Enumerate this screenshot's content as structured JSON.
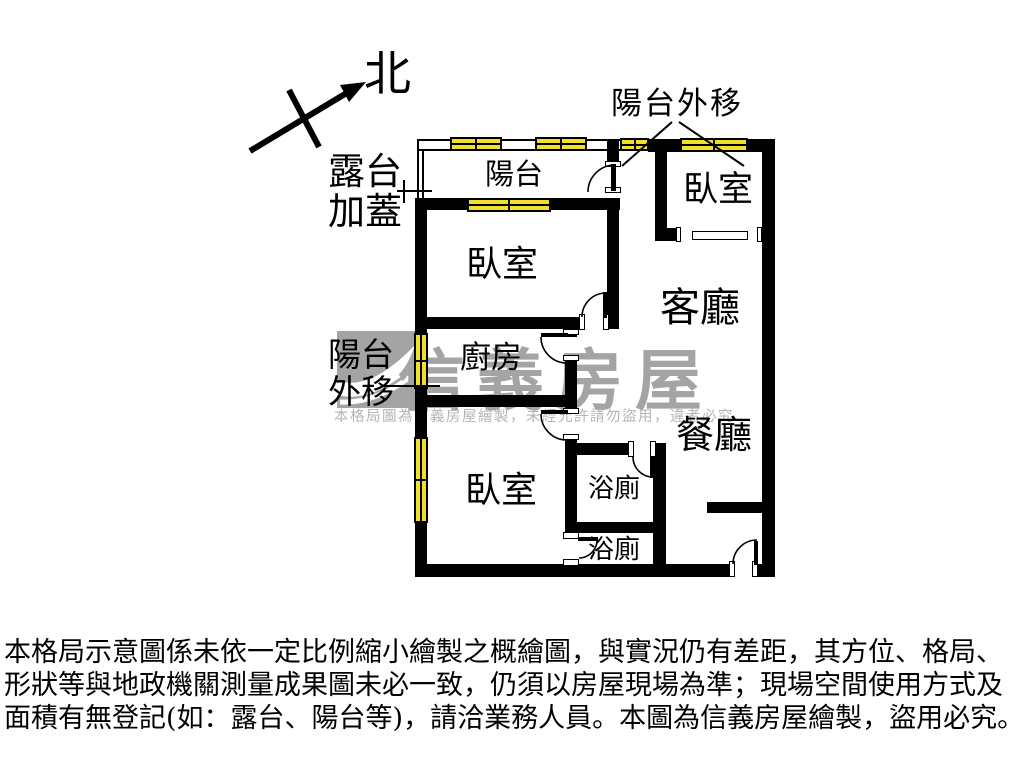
{
  "floor_plan": {
    "compass": {
      "north": "北"
    },
    "rooms": {
      "balcony": "陽台",
      "bedroom_top_right": "臥室",
      "bedroom_main": "臥室",
      "kitchen": "廚房",
      "living_room": "客廳",
      "dining_room": "餐廳",
      "bedroom_lower": "臥室",
      "bathroom_upper": "浴廁",
      "bathroom_lower": "浴廁"
    },
    "annotations": {
      "balcony_extended_top": "陽台外移",
      "terrace_covered_line1": "露台",
      "terrace_covered_line2": "加蓋",
      "balcony_extended_left_line1": "陽台",
      "balcony_extended_left_line2": "外移"
    },
    "watermark": {
      "brand": "信義房屋",
      "notice": "本格局圖為信義房屋繪製，未經允許請勿盜用，違者必究"
    },
    "disclaimer": {
      "line1": "本格局示意圖係未依一定比例縮小繪製之概繪圖，與實況仍有差距，其方位、格局、",
      "line2": "形狀等與地政機關測量成果圖未必一致，仍須以房屋現場為準；現場空間使用方式及",
      "line3": "面積有無登記(如：露台、陽台等)，請洽業務人員。本圖為信義房屋繪製，盜用必究。"
    },
    "colors": {
      "wall": "#000000",
      "window": "#f0df2b",
      "watermark_gray": "#a4a4a4"
    }
  }
}
